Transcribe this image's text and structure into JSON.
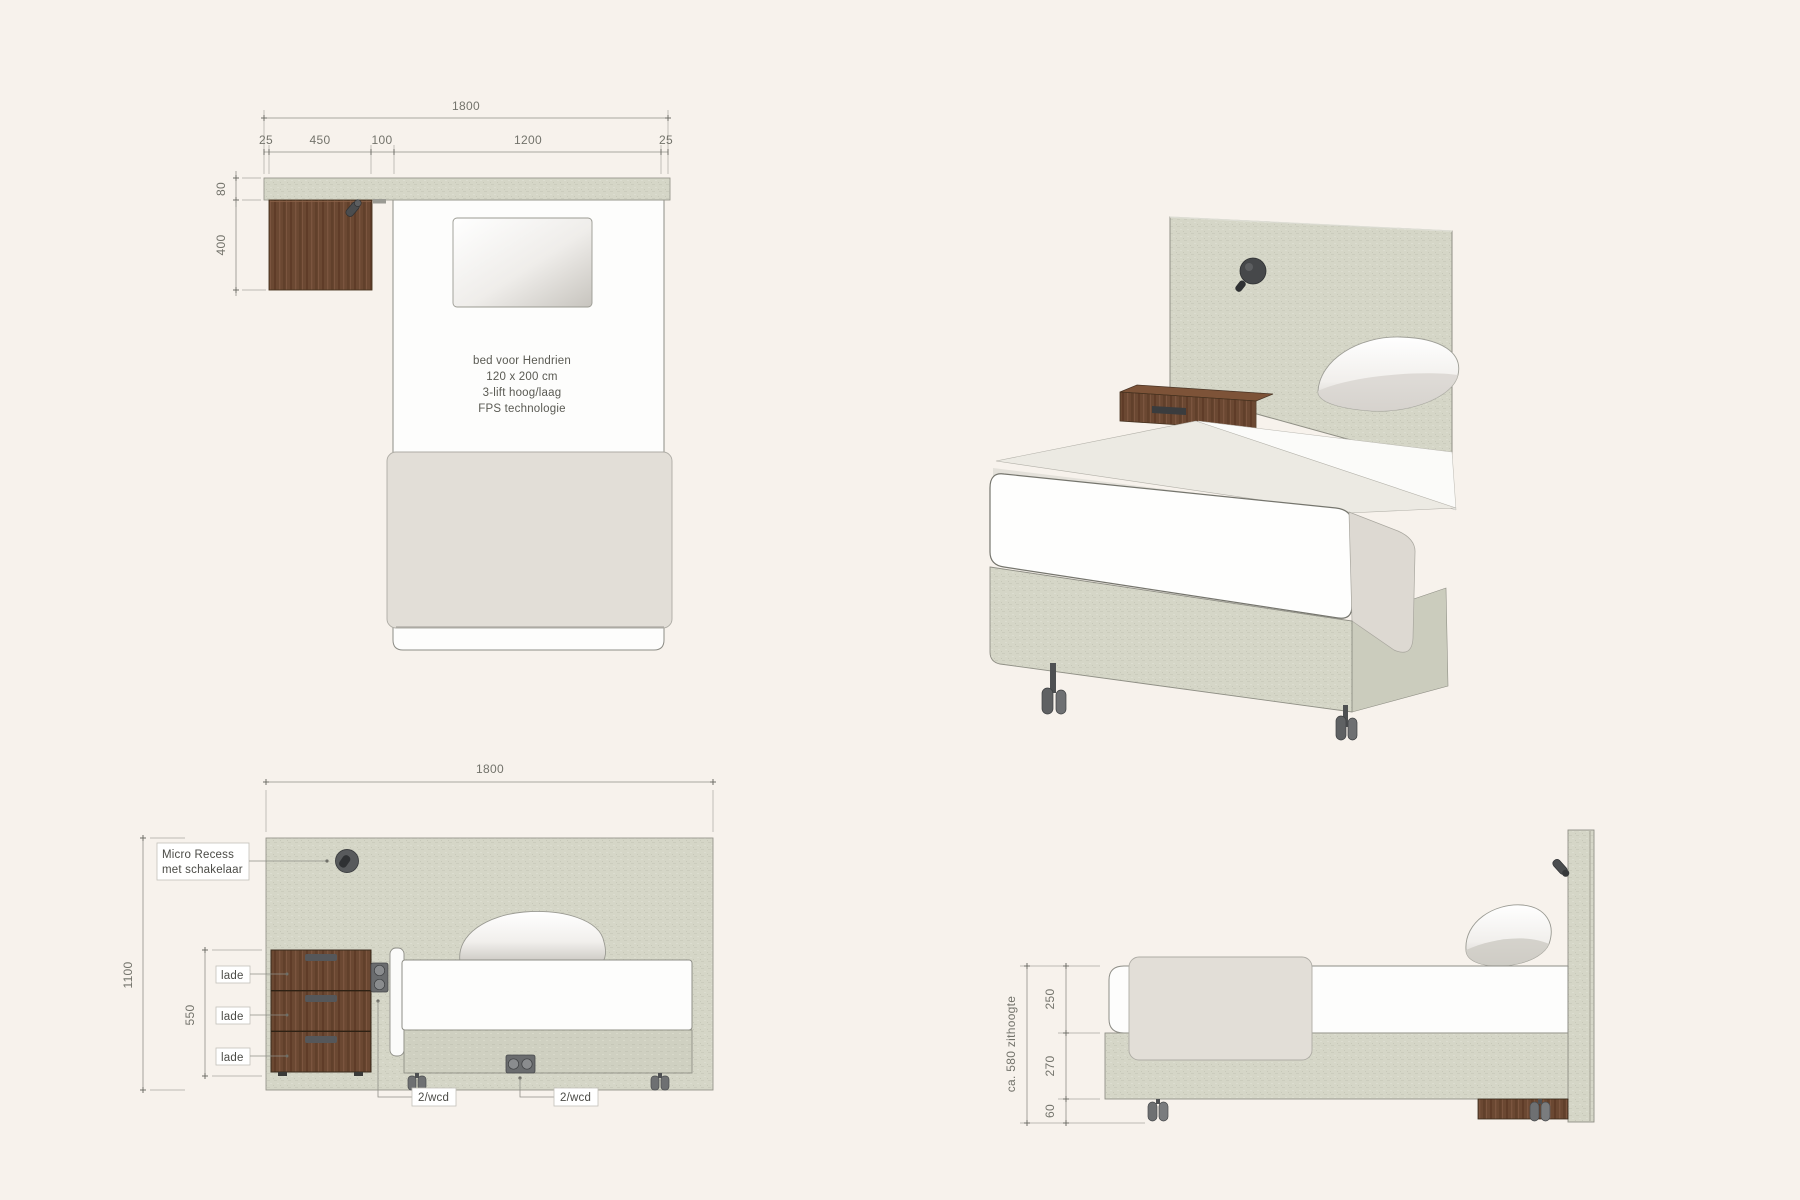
{
  "page": {
    "background_color": "#f7f2ec",
    "drawing_type": "bed technical drawing, 4 views"
  },
  "plan_view": {
    "total_width_dim": "1800",
    "segment_dims": [
      "25",
      "450",
      "100",
      "1200",
      "25"
    ],
    "headboard_thickness_dim": "80",
    "cabinet_depth_dim": "400",
    "note_lines": [
      "bed voor Hendrien",
      "120 x 200 cm",
      "3-lift hoog/laag",
      "FPS technologie"
    ]
  },
  "front_view": {
    "width_dim": "1800",
    "height_dim": "1100",
    "cabinet_height_dim": "550",
    "recess_label_line1": "Micro Recess",
    "recess_label_line2": "met schakelaar",
    "drawer_labels": [
      "lade",
      "lade",
      "lade"
    ],
    "socket_label_left": "2/wcd",
    "socket_label_center": "2/wcd"
  },
  "side_view": {
    "mattress_height_dim": "250",
    "base_height_dim": "270",
    "caster_height_dim": "60",
    "seat_height_label": "ca. 580 zithoogte"
  },
  "colors": {
    "background": "#f7f2ec",
    "fabric_linen": "#d5d6c7",
    "fabric_linen_dark": "#cfd0c1",
    "wood": "#6b4832",
    "mattress_white": "#fdfdfc",
    "blanket": "#e2ded7",
    "hardware_grey": "#55575a",
    "dim_line_grey": "#8f8f88"
  }
}
